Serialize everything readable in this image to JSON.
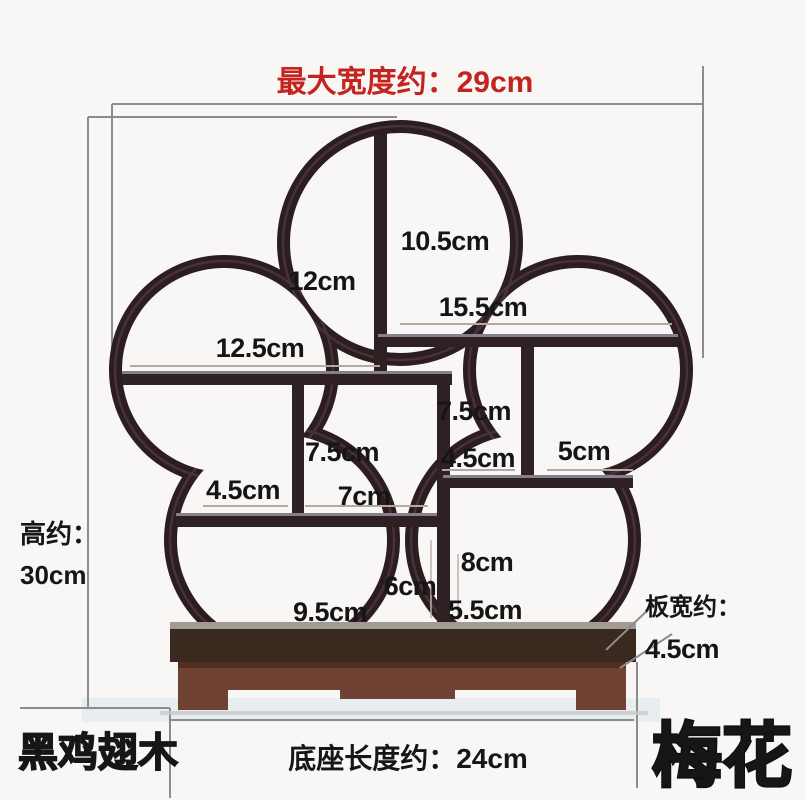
{
  "title": {
    "max_width": "最大宽度约：29cm"
  },
  "side": {
    "height_prefix": "高约：",
    "height_value": "30cm",
    "board_prefix": "板宽约：",
    "board_value": "4.5cm"
  },
  "bottom": {
    "wood_type": "黑鸡翅木",
    "base_length": "底座长度约：24cm",
    "product_name": "梅花"
  },
  "compartments": [
    {
      "id": "top-left-height",
      "value": "12cm"
    },
    {
      "id": "top-right-height",
      "value": "10.5cm"
    },
    {
      "id": "upper-right-shelf-width",
      "value": "15.5cm"
    },
    {
      "id": "upper-left-shelf-width",
      "value": "12.5cm"
    },
    {
      "id": "mid-center-height",
      "value": "7.5cm"
    },
    {
      "id": "mid-left-width",
      "value": "4.5cm"
    },
    {
      "id": "mid-center-width",
      "value": "7cm"
    },
    {
      "id": "mid-right-height",
      "value": "7.5cm"
    },
    {
      "id": "mid-right-width",
      "value": "4.5cm"
    },
    {
      "id": "right-shelf-width",
      "value": "5cm"
    },
    {
      "id": "lower-center-height",
      "value": "6cm"
    },
    {
      "id": "lower-right-height",
      "value": "8cm"
    },
    {
      "id": "lower-left-width",
      "value": "9.5cm"
    },
    {
      "id": "lower-right-width",
      "value": "5.5cm"
    }
  ],
  "colors": {
    "accent_red": "#c4241f",
    "frame_wood": "#2c1d21",
    "base_wood": "#6f4233",
    "dim_line": "#8c8c8c",
    "text": "#151515",
    "background": "#f8f7f5"
  }
}
